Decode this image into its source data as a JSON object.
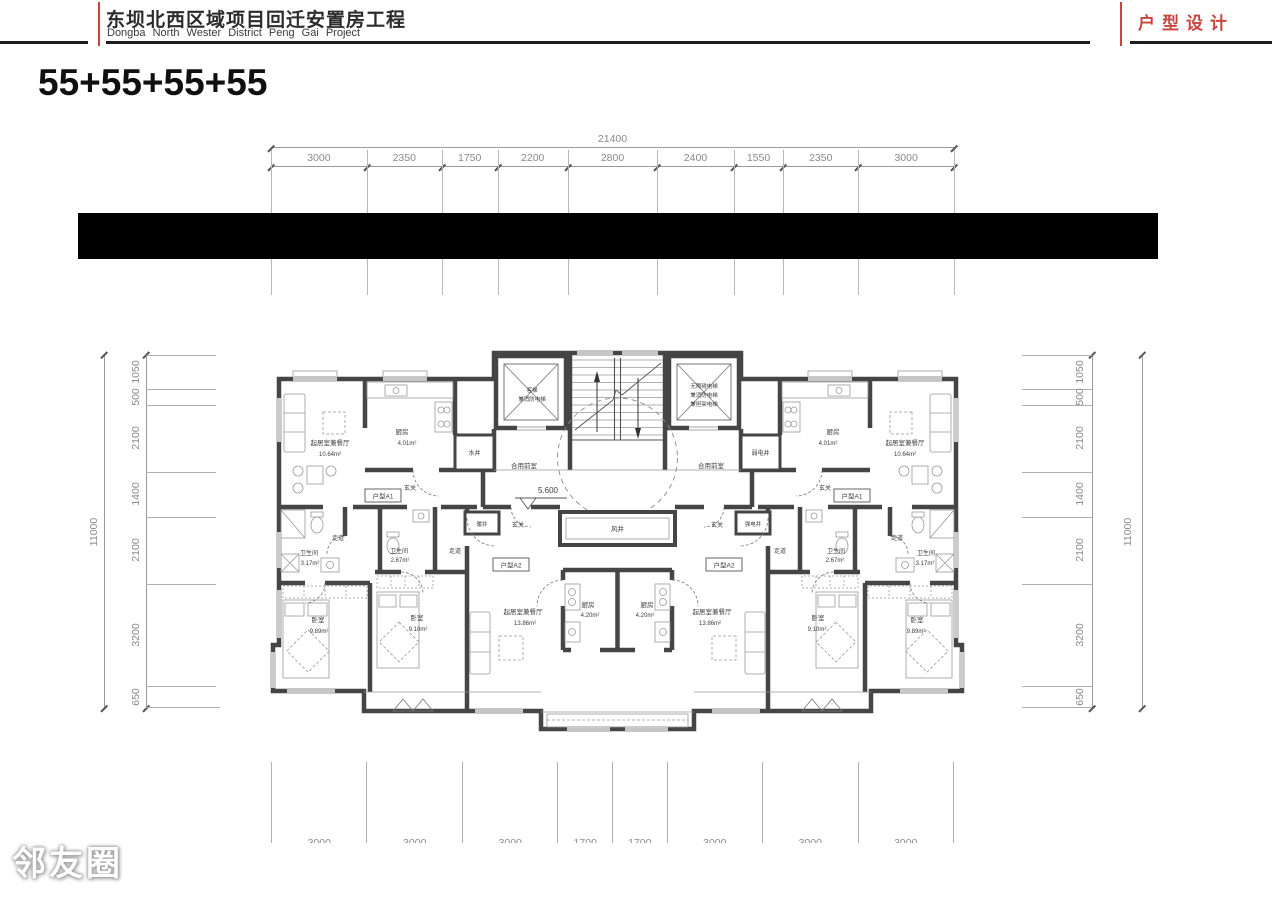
{
  "header": {
    "title_zh": "东坝北西区域项目回迁安置房工程",
    "title_en": "Dongba North Wester District Peng Gai Project",
    "tag": "户型设计"
  },
  "page_title": "55+55+55+55",
  "watermark": "邻友圈",
  "colors": {
    "accent_red": "#c8453e",
    "wall": "#454545",
    "bar": "#000000",
    "dim_text": "#8a8a8a"
  },
  "dims": {
    "top": {
      "total": "21400",
      "segments": [
        "3000",
        "2350",
        "1750",
        "2200",
        "2800",
        "2400",
        "1550",
        "2350",
        "3000"
      ]
    },
    "bottom": {
      "segments": [
        "3000",
        "3000",
        "3000",
        "1700",
        "1700",
        "3000",
        "3000",
        "3000"
      ]
    },
    "left": {
      "total": "11000",
      "segments": [
        "1050",
        "500",
        "2100",
        "1400",
        "2100",
        "3200",
        "650"
      ]
    },
    "right": {
      "total": "11000",
      "segments": [
        "1050",
        "500",
        "2100",
        "1400",
        "2100",
        "3200",
        "650"
      ]
    }
  },
  "plan": {
    "level_mark": "5.600",
    "unit_a1": "户型A1",
    "unit_a2": "户型A2",
    "lobby": "合用前室",
    "entry": "玄关",
    "corridor": "走道",
    "wind_shaft": "风井",
    "water_shaft": "水井",
    "weak_shaft": "弱电井",
    "strong_shaft": "强电井",
    "heat_shaft": "暖井",
    "elevator_left": {
      "l1": "客梯",
      "l2": "兼消防电梯"
    },
    "elevator_right": {
      "l1": "无障碍电梯",
      "l2": "兼消防电梯",
      "l3": "兼担架电梯"
    },
    "rooms": [
      {
        "name": "起居室兼餐厅",
        "area": "10.64m²"
      },
      {
        "name": "厨房",
        "area": "4.01m²"
      },
      {
        "name": "卫生间",
        "area": "3.17m²"
      },
      {
        "name": "卫生间",
        "area": "2.67m²"
      },
      {
        "name": "卧室",
        "area": "9.89m²"
      },
      {
        "name": "卧室",
        "area": "9.10m²"
      },
      {
        "name": "起居室兼餐厅",
        "area": "13.86m²"
      },
      {
        "name": "厨房",
        "area": "4.20m²"
      },
      {
        "name": "厨房",
        "area": "4.20m²"
      },
      {
        "name": "起居室兼餐厅",
        "area": "13.86m²"
      },
      {
        "name": "卧室",
        "area": "9.10m²"
      },
      {
        "name": "卧室",
        "area": "9.89m²"
      },
      {
        "name": "卫生间",
        "area": "2.67m²"
      },
      {
        "name": "卫生间",
        "area": "3.17m²"
      },
      {
        "name": "厨房",
        "area": "4.01m²"
      },
      {
        "name": "起居室兼餐厅",
        "area": "10.64m²"
      }
    ]
  }
}
